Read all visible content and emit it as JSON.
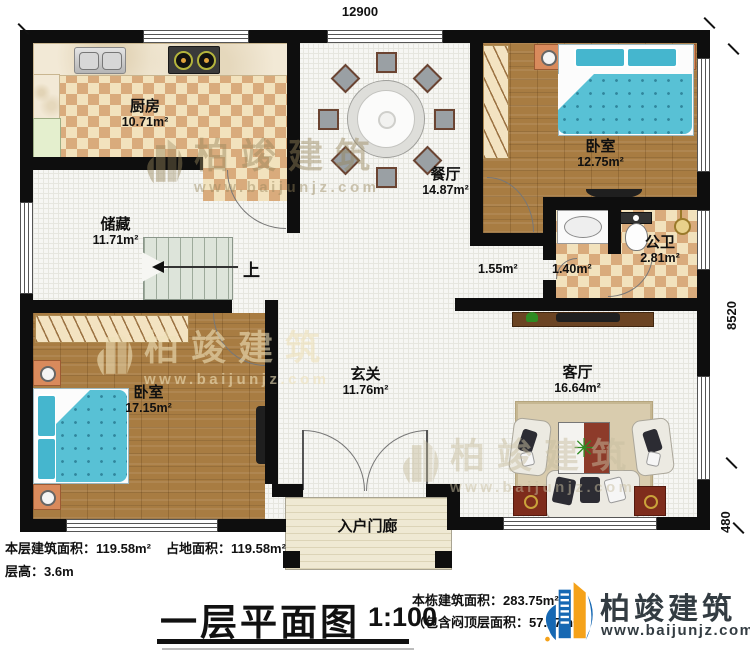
{
  "title_block": {
    "title": "一层平面图",
    "scale": "1:100",
    "floor_area": "本层建筑面积：119.58m²",
    "land_area": "占地面积：119.58m²",
    "floor_height": "层高：3.6m",
    "building_area": "本栋建筑面积：283.75m²",
    "attic_note": "（包含闷顶层面积：57.07m²）"
  },
  "dimensions": {
    "top": "12900",
    "right": "8520",
    "right_offset": "480"
  },
  "rooms": {
    "kitchen": {
      "name": "厨房",
      "area": "10.71m²"
    },
    "dining": {
      "name": "餐厅",
      "area": "14.87m²"
    },
    "bedroom_top": {
      "name": "卧室",
      "area": "12.75m²"
    },
    "storage": {
      "name": "储藏",
      "area": "11.71m²"
    },
    "corridor": {
      "area": "1.55m²"
    },
    "wash": {
      "area": "1.40m²"
    },
    "bath": {
      "name": "公卫",
      "area": "2.81m²"
    },
    "bedroom_bottom": {
      "name": "卧室",
      "area": "17.15m²"
    },
    "hall": {
      "name": "玄关",
      "area": "11.76m²"
    },
    "living": {
      "name": "客厅",
      "area": "16.64m²"
    },
    "porch": {
      "name": "入户门廊"
    }
  },
  "stairs": {
    "direction": "上"
  },
  "icons": {
    "plant": "✳"
  },
  "brand": {
    "name": "柏竣建筑",
    "website": "www.baijunjz.com"
  },
  "watermark": {
    "name": "柏竣建筑",
    "website": "www.baijunjz.com"
  },
  "colors": {
    "accent_blue": "#1668b3",
    "accent_orange": "#f5a21a",
    "wall": "#0e0e0e"
  }
}
